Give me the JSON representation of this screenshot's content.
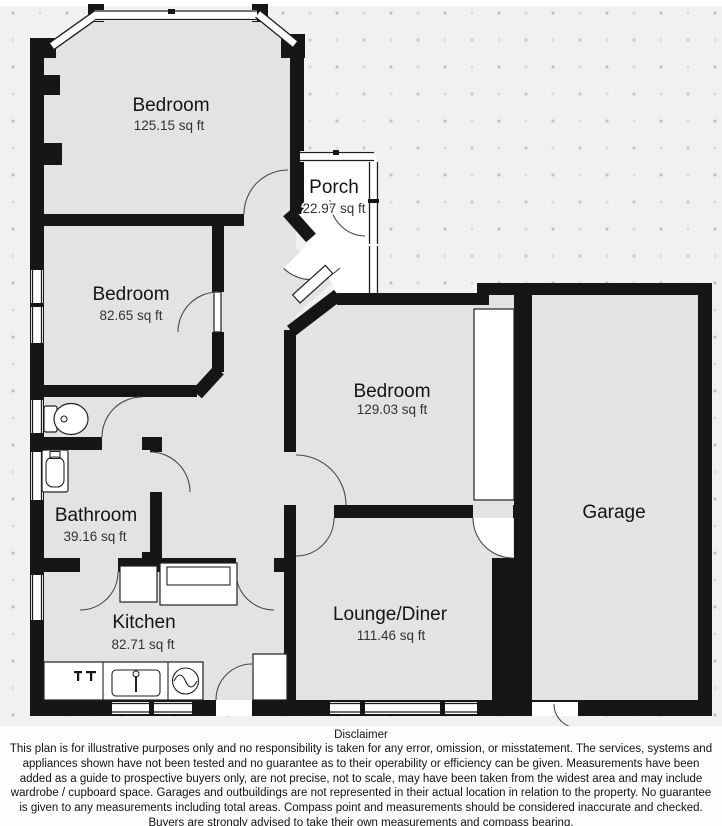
{
  "plan": {
    "colors": {
      "wall": "#161616",
      "room_fill": "#e3e3e3",
      "background": "#f1f1f2",
      "porch_fill": "#ffffff",
      "dot": "#c9c9c9"
    },
    "rooms": [
      {
        "name": "Bedroom",
        "area": "125.15 sq ft"
      },
      {
        "name": "Bedroom",
        "area": "82.65 sq ft"
      },
      {
        "name": "Porch",
        "area": "22.97 sq ft"
      },
      {
        "name": "Bedroom",
        "area": "129.03 sq ft"
      },
      {
        "name": "Bathroom",
        "area": "39.16 sq ft"
      },
      {
        "name": "Kitchen",
        "area": "82.71 sq ft"
      },
      {
        "name": "Lounge/Diner",
        "area": "111.46 sq ft"
      },
      {
        "name": "Garage",
        "area": ""
      }
    ]
  },
  "disclaimer": {
    "title": "Disclaimer",
    "body": "This plan is for illustrative purposes only and no responsibility is taken for any error, omission, or misstatement. The services, systems and appliances shown have not been tested and no guarantee as to their operability or efficiency can be given. Measurements have been added as a guide to prospective buyers only, are not precise, not to scale, may have been taken from the widest area and may include wardrobe / cupboard space. Garages and outbuildings are not represented in their actual location in relation to the property. No guarantee is given to any measurements including total areas. Compass point and measurements should be considered inaccurate and checked. Buyers are strongly advised to take their own measurements and compass bearing."
  }
}
